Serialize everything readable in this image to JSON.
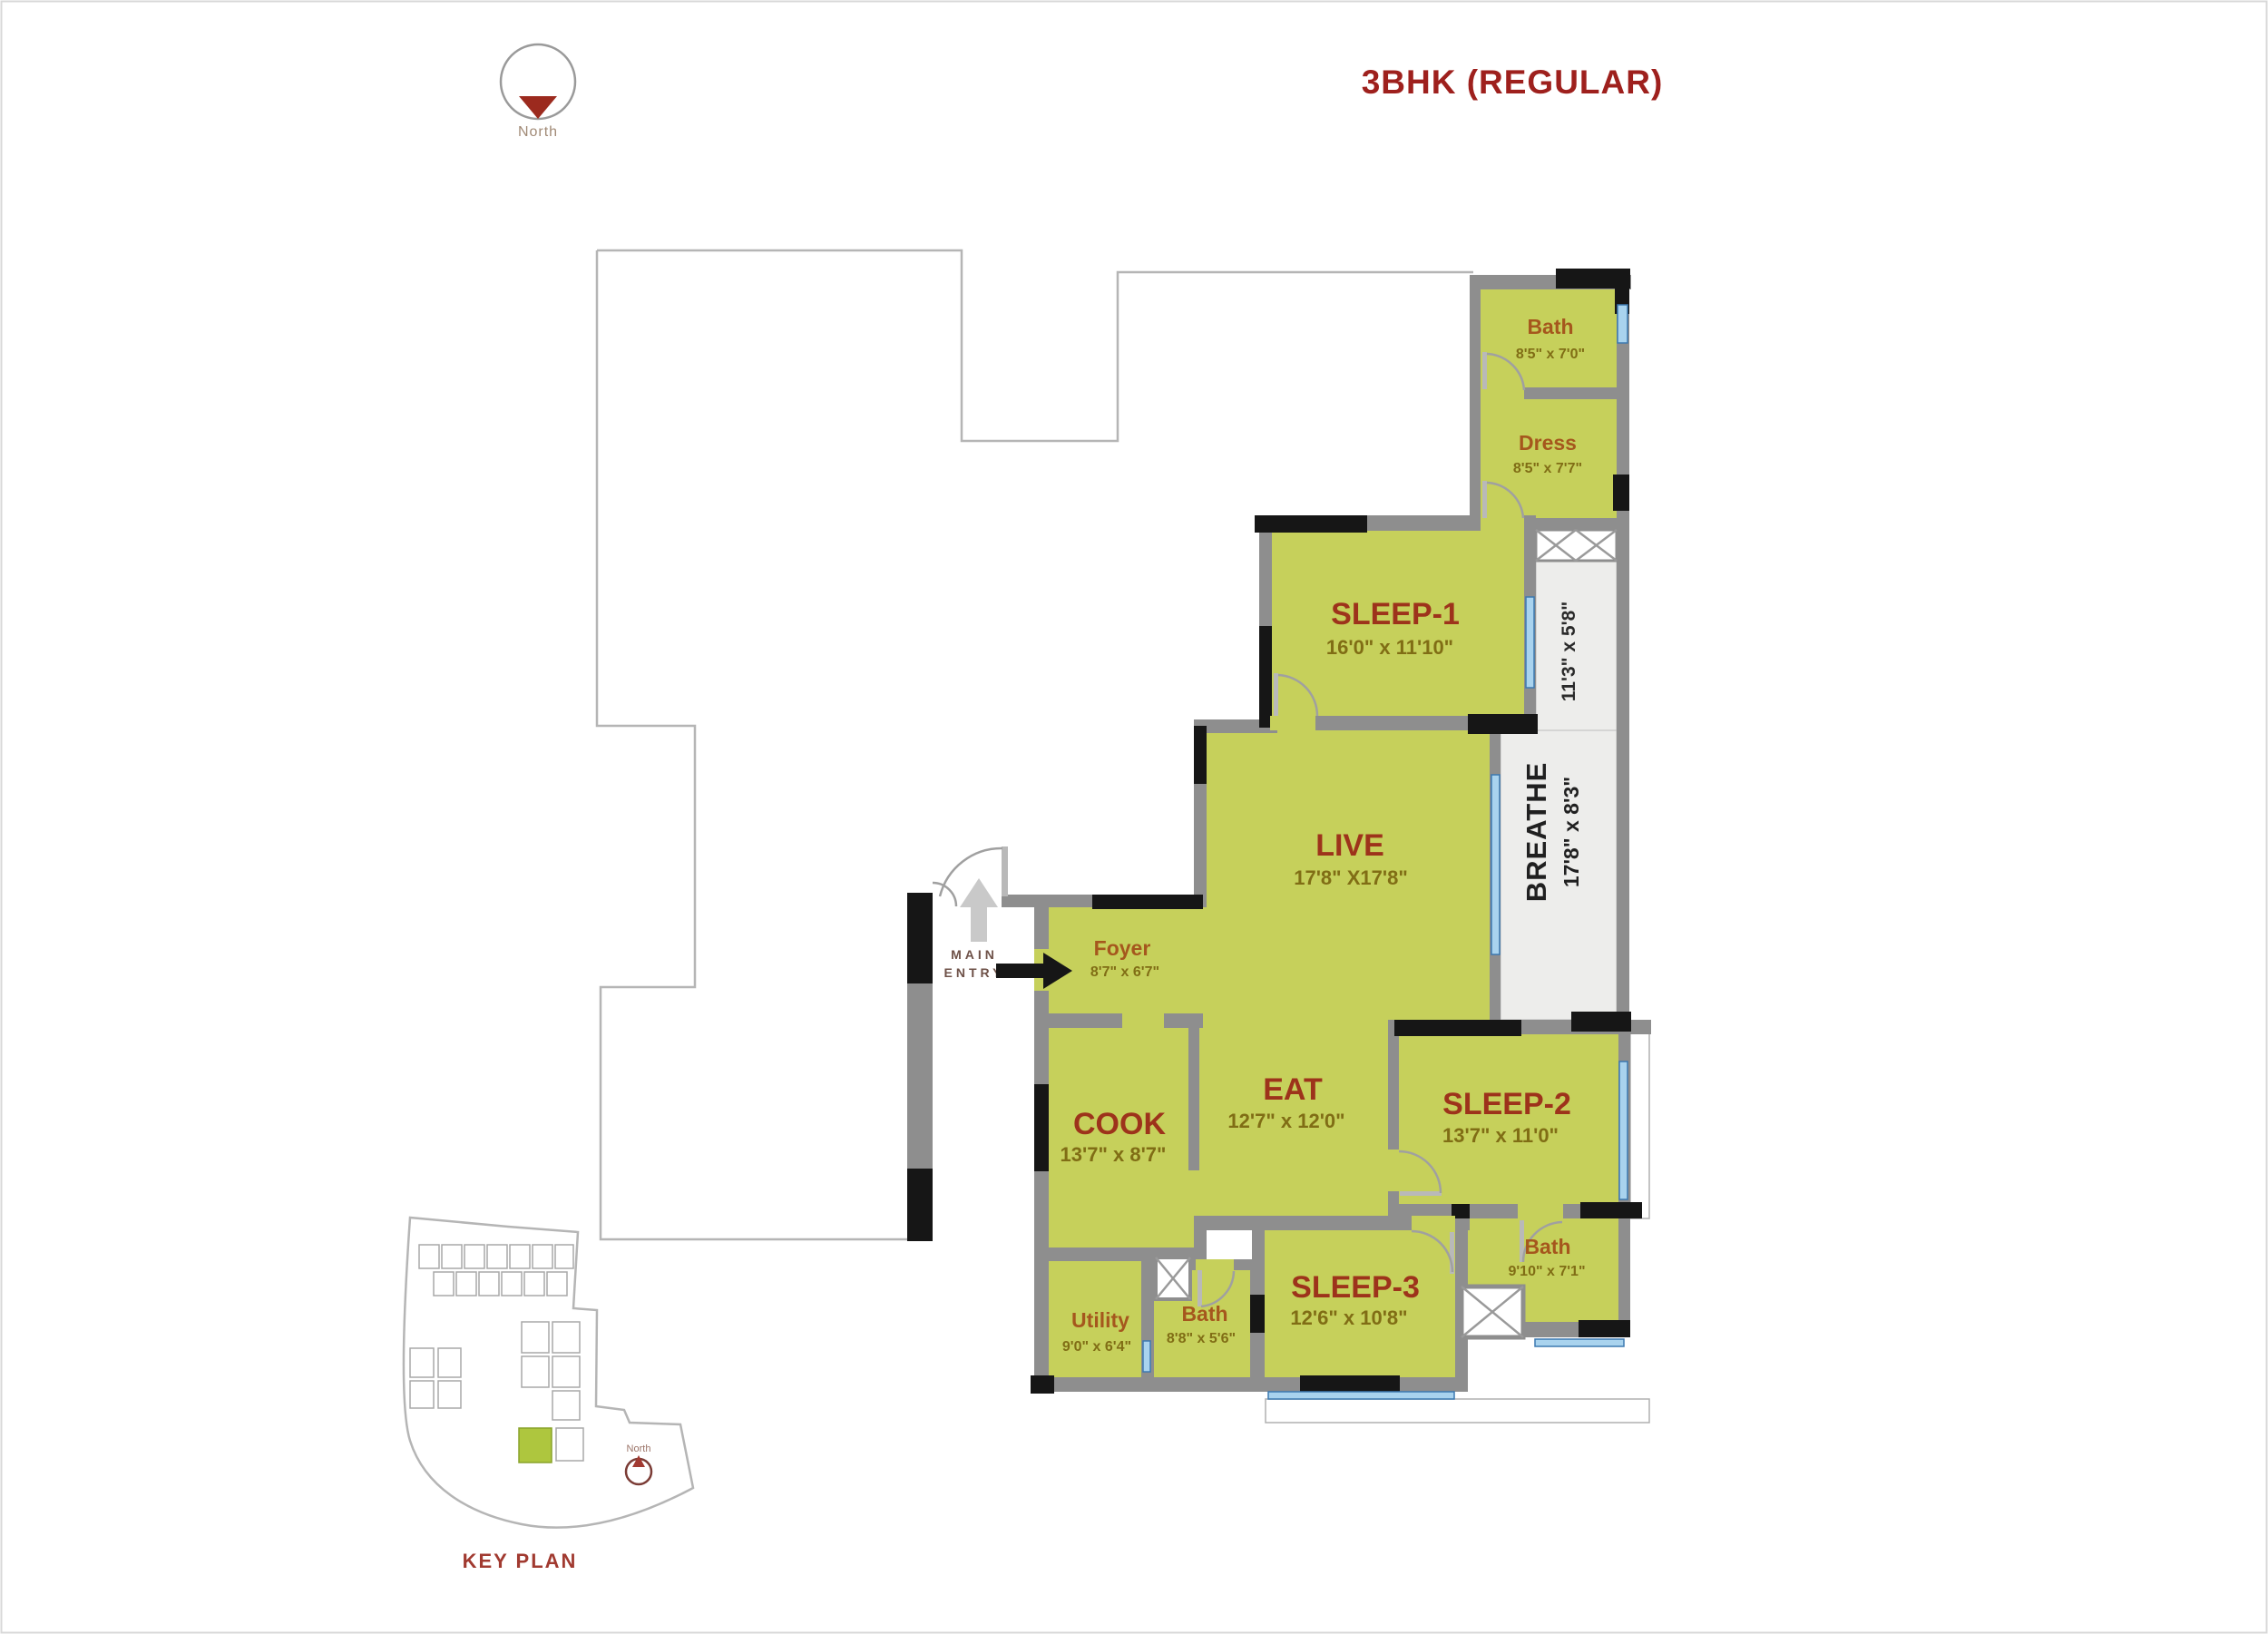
{
  "title": "3BHK (REGULAR)",
  "compass": {
    "label": "North"
  },
  "entry": {
    "line1": "MAIN",
    "line2": "ENTRY"
  },
  "rooms": {
    "bath1": {
      "name": "Bath",
      "dims": "8'5\" x 7'0\""
    },
    "dress": {
      "name": "Dress",
      "dims": "8'5\" x 7'7\""
    },
    "sleep1": {
      "name": "SLEEP-1",
      "dims": "16'0\" x 11'10\""
    },
    "balcony_upper": {
      "dims": "11'3\" x 5'8\""
    },
    "breathe": {
      "name": "BREATHE",
      "dims": "17'8\" x 8'3\""
    },
    "live": {
      "name": "LIVE",
      "dims": "17'8\" X17'8\""
    },
    "foyer": {
      "name": "Foyer",
      "dims": "8'7\" x 6'7\""
    },
    "cook": {
      "name": "COOK",
      "dims": "13'7\" x 8'7\""
    },
    "eat": {
      "name": "EAT",
      "dims": "12'7\" x 12'0\""
    },
    "sleep2": {
      "name": "SLEEP-2",
      "dims": "13'7\" x 11'0\""
    },
    "sleep3": {
      "name": "SLEEP-3",
      "dims": "12'6\" x 10'8\""
    },
    "bath3": {
      "name": "Bath",
      "dims": "9'10\" x 7'1\""
    },
    "bath2": {
      "name": "Bath",
      "dims": "8'8\" x 5'6\""
    },
    "utility": {
      "name": "Utility",
      "dims": "9'0\" x 6'4\""
    }
  },
  "key_plan": {
    "label": "KEY PLAN",
    "north_label": "North"
  },
  "colors": {
    "room_fill": "#c6d05b",
    "wall": "#8e8e8e",
    "wall_dark": "#161616",
    "window_blue": "#a9d3ee",
    "balcony_fill": "#ededeb",
    "room_name_small": "#a5571d",
    "room_name_large": "#9d331b",
    "room_dims": "#806d15",
    "accent_red": "#9e201d",
    "key_plan_highlight": "#aec63e"
  }
}
